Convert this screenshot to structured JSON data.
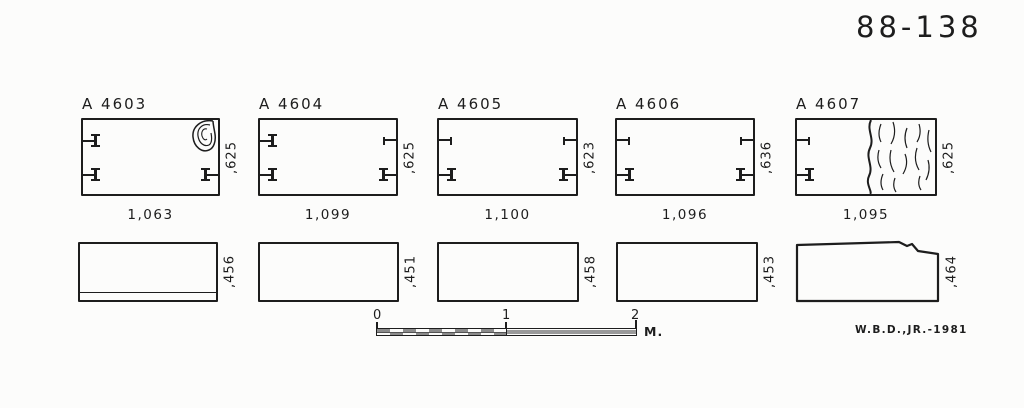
{
  "plate": {
    "number": "88-138",
    "signature": "W.B.D.,JR.-1981"
  },
  "panels": [
    {
      "label": "A 4603",
      "width_dim": "1,063",
      "depth_dim": ",625",
      "height_dim": ",456",
      "clamp_cuttings": [
        "left-top-clamp-icon",
        "left-bottom-clamp-icon",
        "right-bottom-clamp-icon"
      ],
      "damage": "chip-outline-top-right"
    },
    {
      "label": "A 4604",
      "width_dim": "1,099",
      "depth_dim": ",625",
      "height_dim": ",451",
      "clamp_cuttings": [
        "left-top-clamp-icon",
        "left-bottom-clamp-icon",
        "right-top-dashed-clamp-icon",
        "right-bottom-clamp-icon"
      ]
    },
    {
      "label": "A 4605",
      "width_dim": "1,100",
      "depth_dim": ",623",
      "height_dim": ",458",
      "clamp_cuttings": [
        "left-top-dashed-clamp-icon",
        "left-bottom-clamp-icon",
        "right-top-dashed-clamp-icon",
        "right-bottom-clamp-icon"
      ]
    },
    {
      "label": "A 4606",
      "width_dim": "1,096",
      "depth_dim": ",636",
      "height_dim": ",453",
      "clamp_cuttings": [
        "left-top-dashed-clamp-icon",
        "left-bottom-clamp-icon",
        "right-top-dashed-clamp-icon",
        "right-bottom-clamp-icon"
      ]
    },
    {
      "label": "A 4607",
      "width_dim": "1,095",
      "depth_dim": ",625",
      "height_dim": ",464",
      "clamp_cuttings": [
        "left-top-dashed-clamp-icon",
        "left-bottom-clamp-icon"
      ],
      "damage": "broken-right-end"
    }
  ],
  "scale_bar": {
    "tick_labels": [
      "0",
      "1",
      "2"
    ],
    "unit": "M."
  },
  "colors": {
    "ink": "#1d1d1d",
    "paper": "#fcfcfb"
  }
}
